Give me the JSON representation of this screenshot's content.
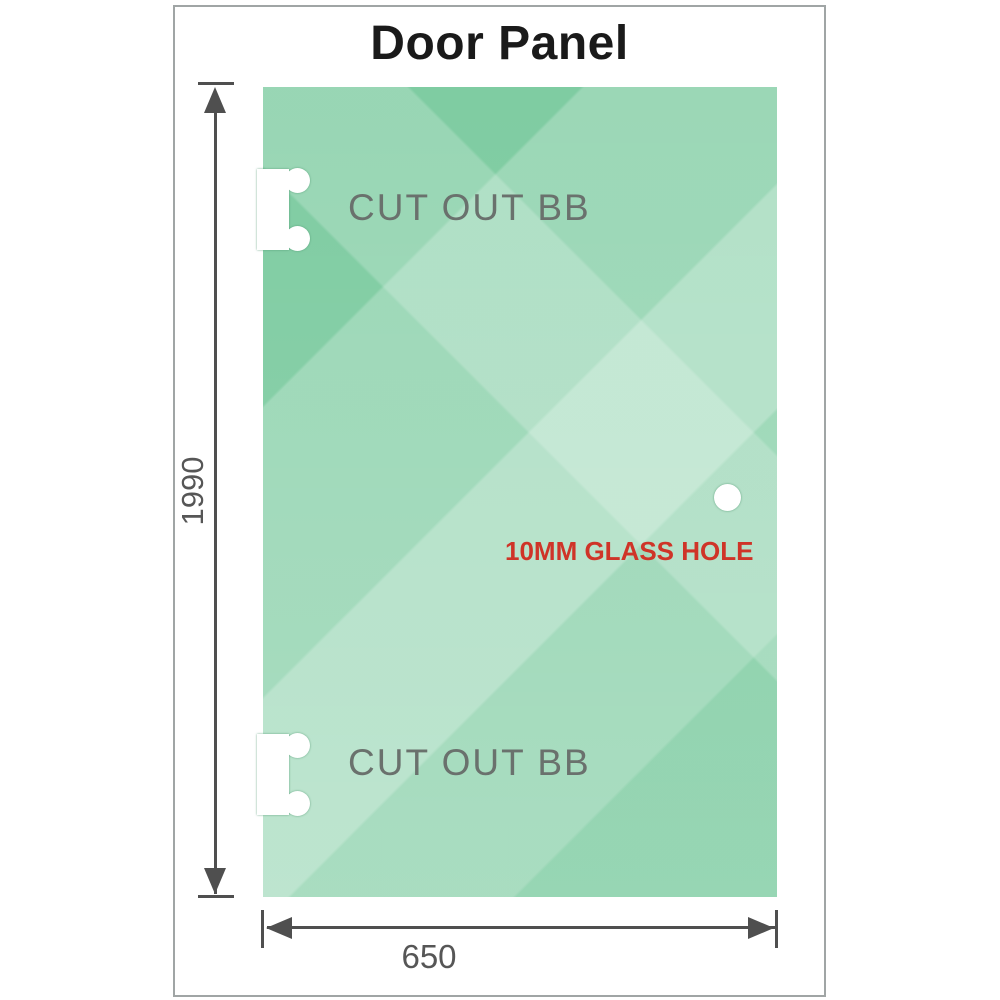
{
  "title": "Door Panel",
  "panel": {
    "cutout_top": {
      "label": "CUT OUT BB"
    },
    "cutout_bottom": {
      "label": "CUT OUT BB"
    },
    "glass_hole": {
      "label": "10MM GLASS HOLE"
    }
  },
  "dimensions": {
    "height": "1990",
    "width": "650"
  },
  "colors": {
    "glass_base": "#7fcca2",
    "glass_highlight": "#c3e9d4",
    "frame_border": "#a0a5a5",
    "dimension_line": "#4f4f4f",
    "cutout_label_gray": "#6a716d",
    "hole_label_red": "#cf3428",
    "title_color": "#1a1a1a"
  },
  "icons": {
    "arrow_up": "dimension arrowhead pointing up",
    "arrow_down": "dimension arrowhead pointing down",
    "arrow_left": "dimension arrowhead pointing left",
    "arrow_right": "dimension arrowhead pointing right"
  }
}
